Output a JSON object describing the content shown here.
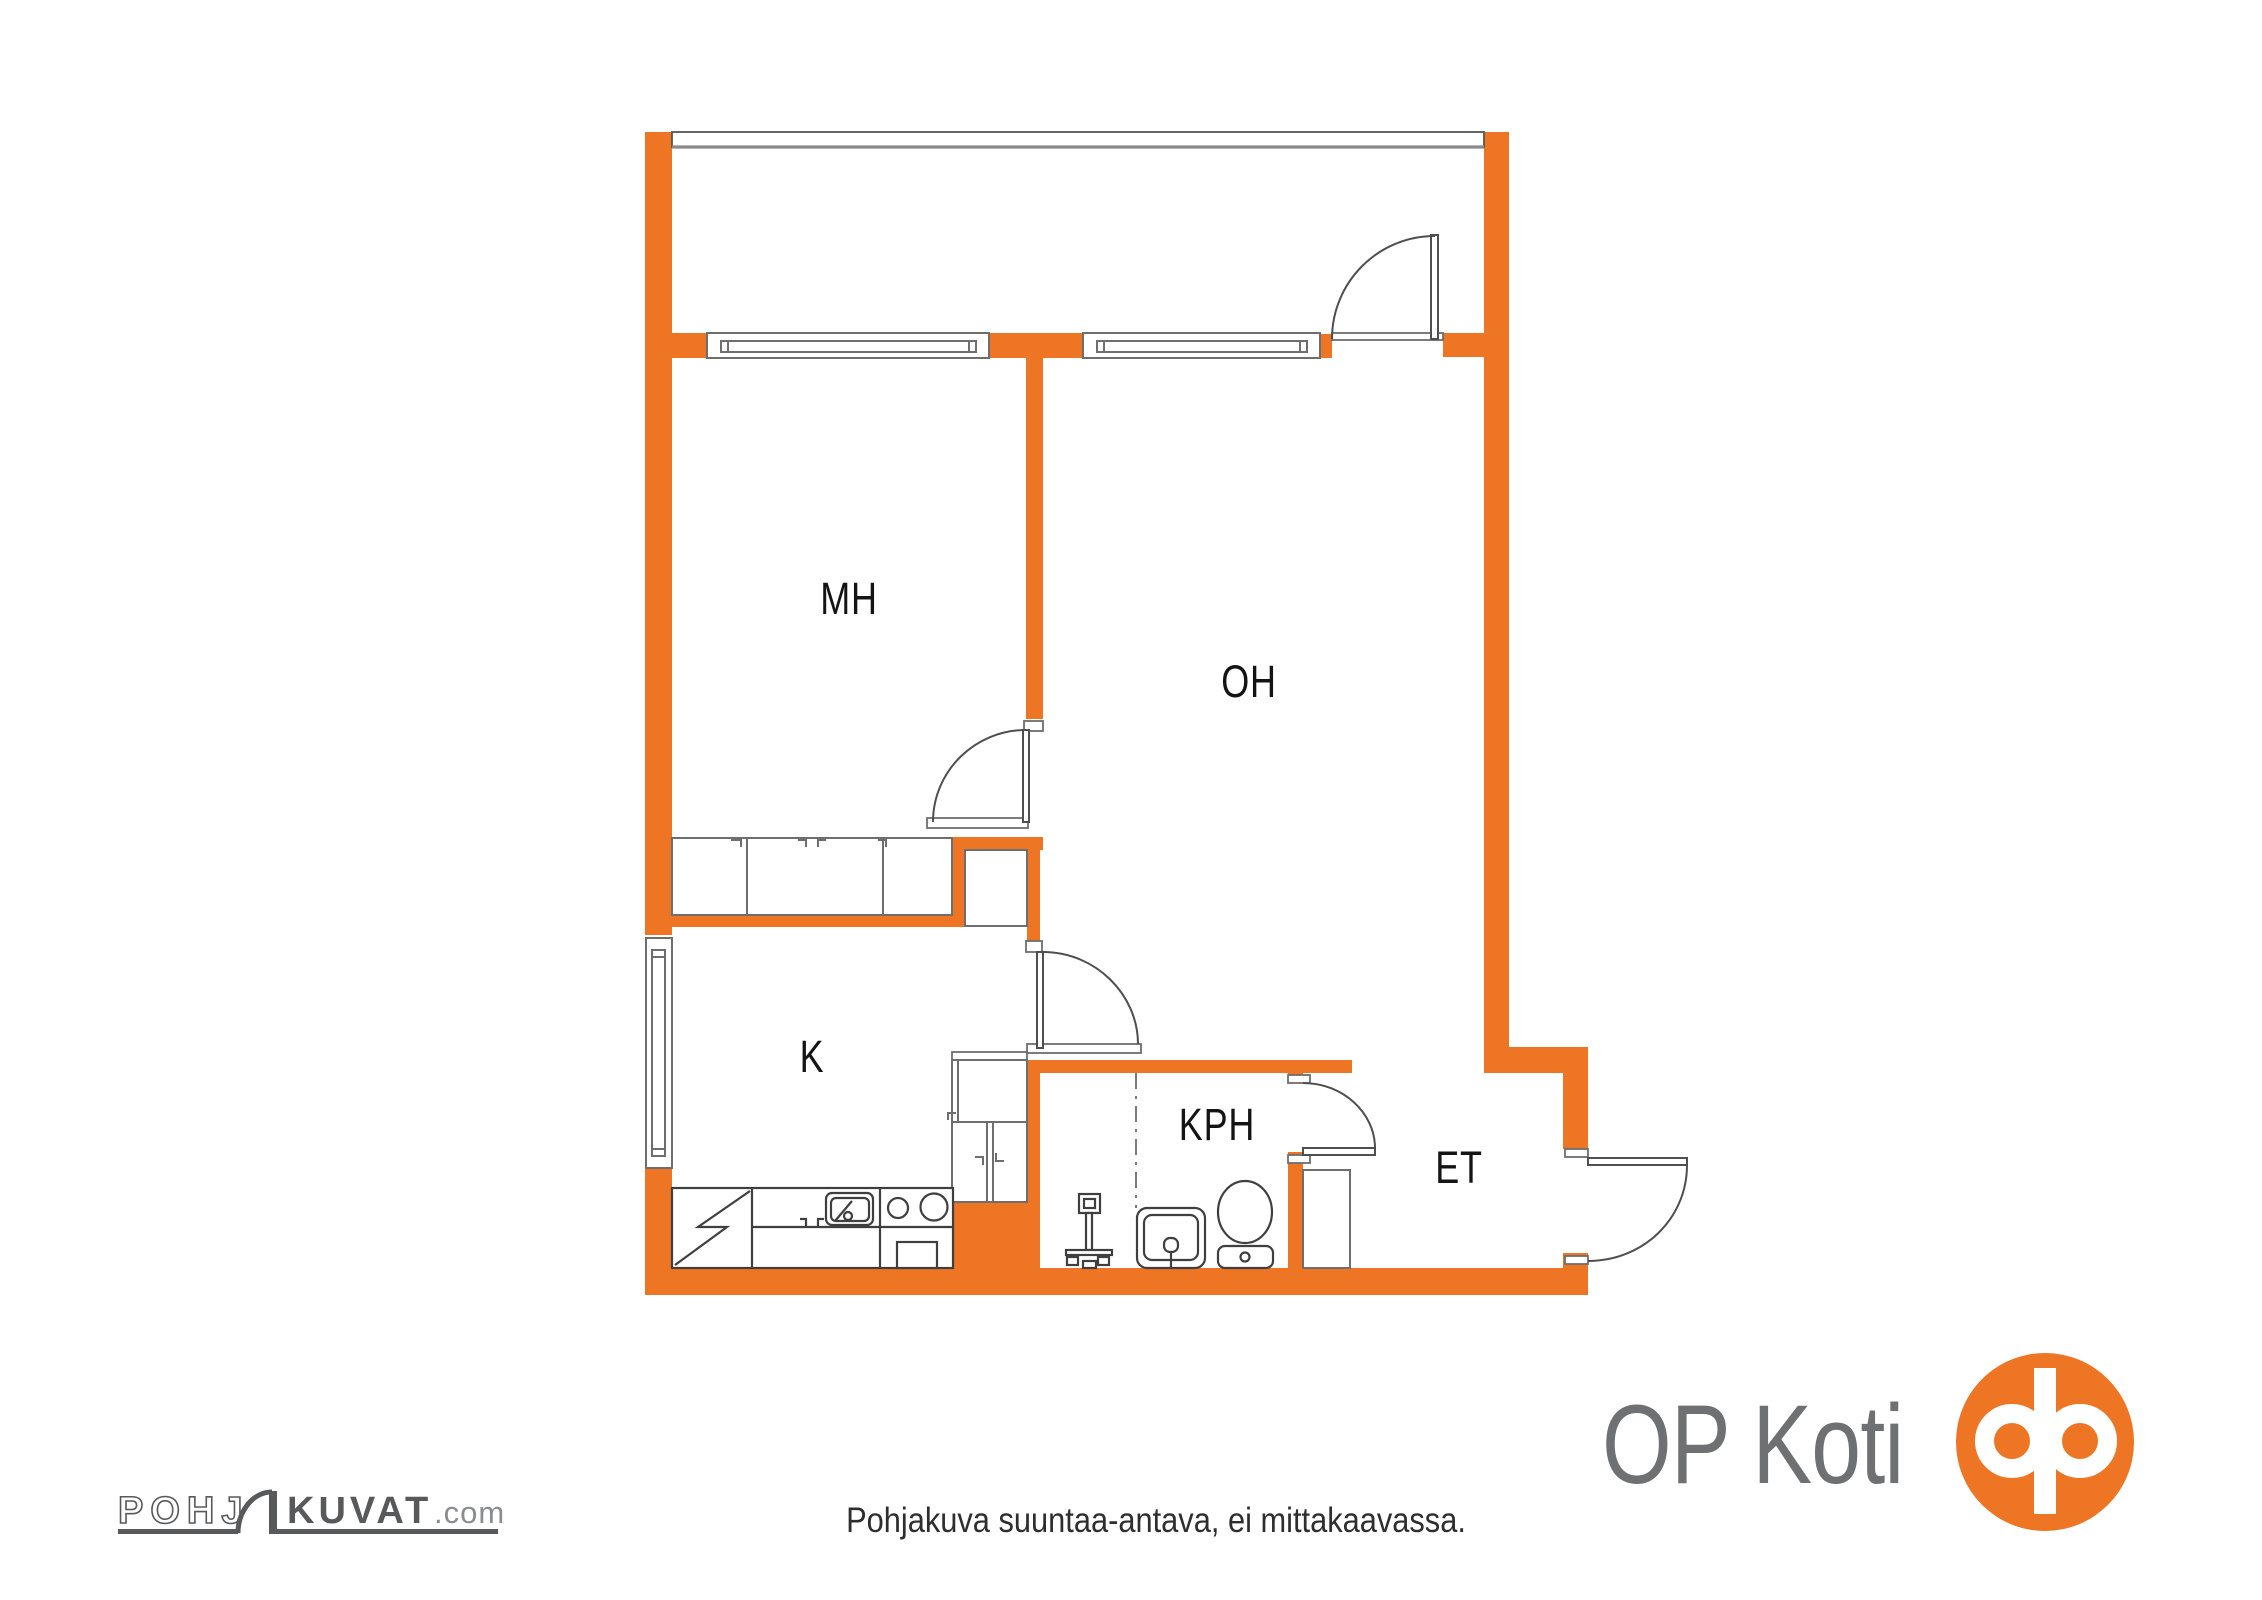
{
  "plan": {
    "rooms": {
      "mh": {
        "label": "MH"
      },
      "oh": {
        "label": "OH"
      },
      "k": {
        "label": "K"
      },
      "kph": {
        "label": "KPH"
      },
      "et": {
        "label": "ET"
      }
    }
  },
  "footer": {
    "disclaimer": "Pohjakuva suuntaa-antava, ei mittakaavassa.",
    "brand_text": "OP Koti",
    "watermark": {
      "outline_part": "POHJ",
      "solid_part": "KUVAT",
      "tld": ".com"
    }
  },
  "colors": {
    "wall_orange": "#EE7524",
    "line_gray": "#6e6e6e",
    "arc_gray": "#4f4f4f",
    "fixture_gray": "#3f3f3f",
    "text_black": "#141414",
    "logo_gray": "#58595b",
    "brand_text_gray": "#6f7072",
    "band_edge_gray": "#8a8a8a"
  }
}
